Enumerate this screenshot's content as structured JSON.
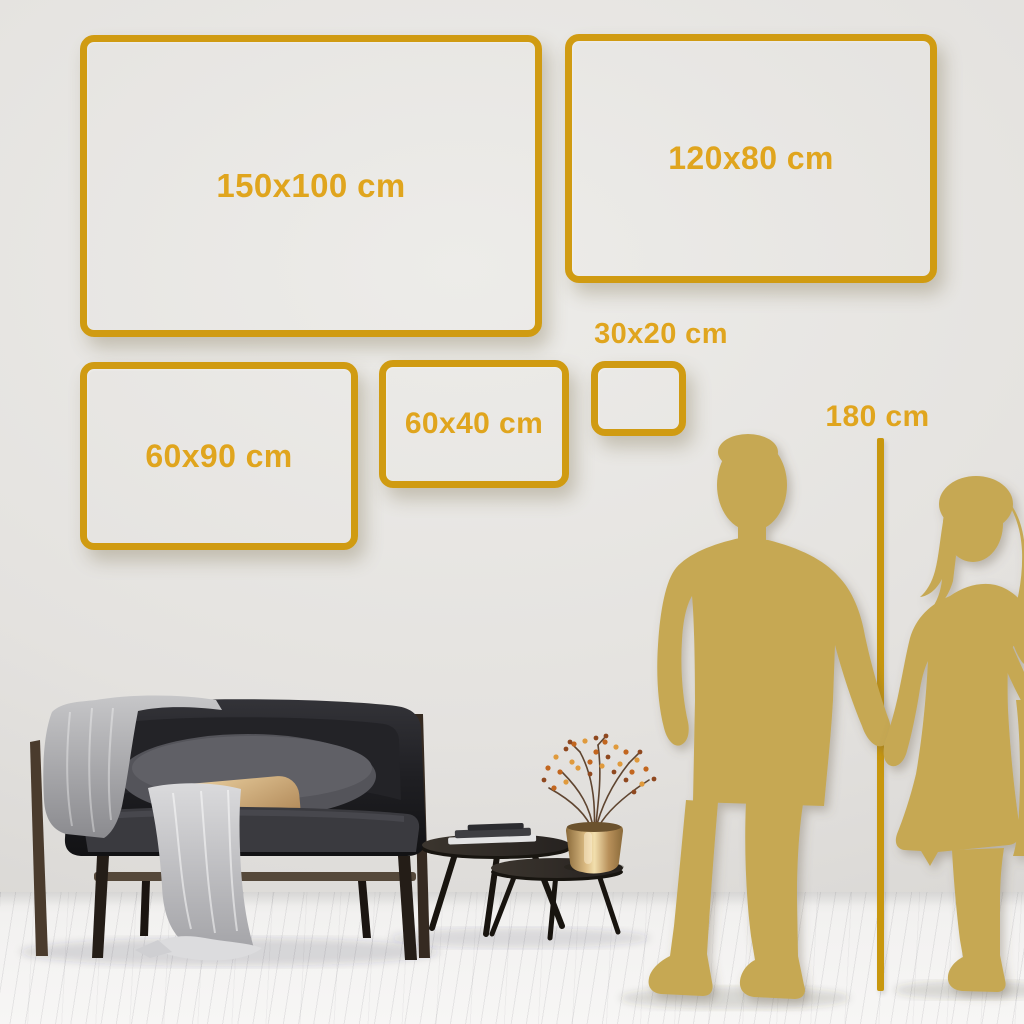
{
  "scene_type": "canvas-size-guide",
  "frames": [
    {
      "label": "150x100 cm"
    },
    {
      "label": "120x80 cm"
    },
    {
      "label": "60x90 cm"
    },
    {
      "label": "60x40 cm"
    },
    {
      "label": "30x20 cm"
    }
  ],
  "height_reference": {
    "label": "180 cm"
  },
  "colors": {
    "frame_gold": "#D09B12",
    "label_gold": "#E0A51E",
    "line_gold": "#C8970E",
    "silhouette_gold": "#C6A853",
    "wall": "#E5E3E0",
    "floor": "#F6F5F4"
  }
}
